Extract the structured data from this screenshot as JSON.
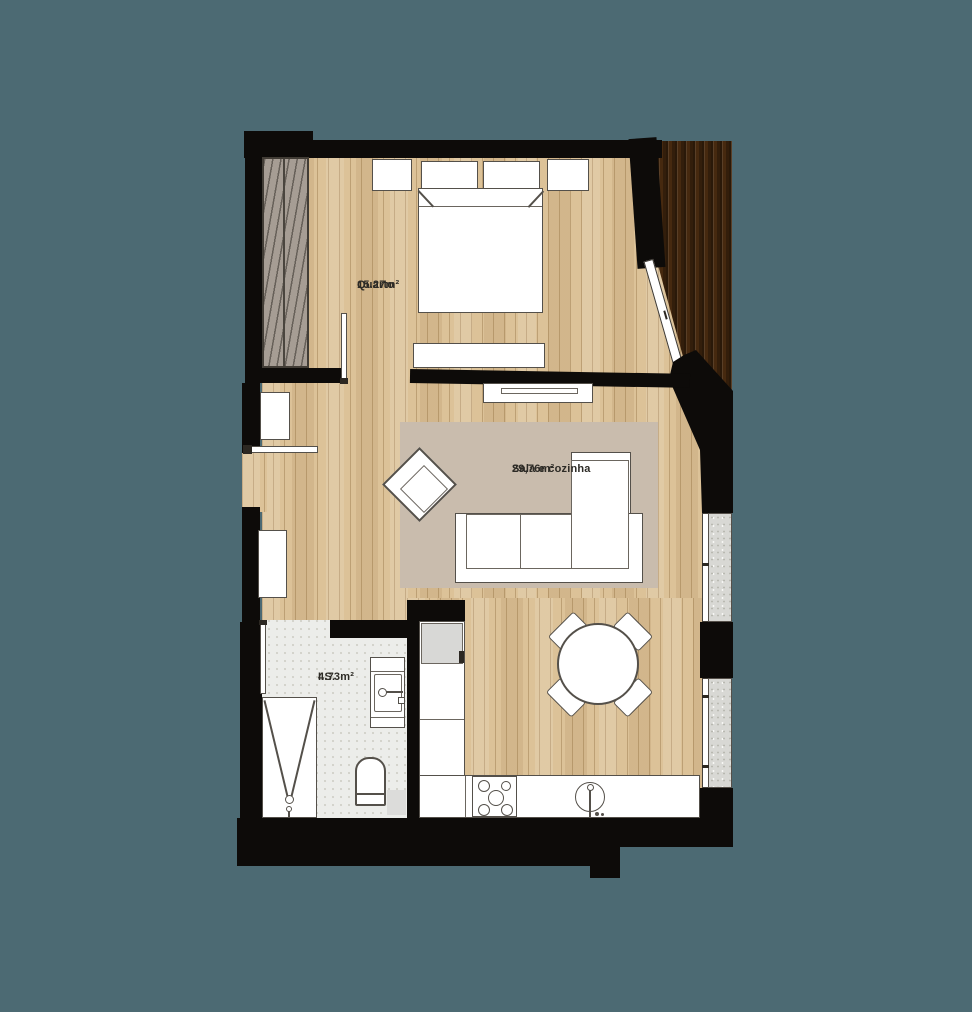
{
  "rooms": {
    "bedroom": {
      "label": "Quarto",
      "area": "15.27m²"
    },
    "living": {
      "label": "Sala e cozinha",
      "area": "29,76m²"
    },
    "bathroom": {
      "label": "I.S.",
      "area": "4.73m²"
    }
  },
  "colors": {
    "background": "#4C6A73",
    "wall": "#0d0b09",
    "wood_floor": "#dcc298",
    "deck_wood": "#46290f",
    "rug": "#c9bcad",
    "bathroom_floor": "#ecedea",
    "furniture_fill": "#ffffff",
    "furniture_outline": "#54504a",
    "label_text": "#2d2b26"
  }
}
